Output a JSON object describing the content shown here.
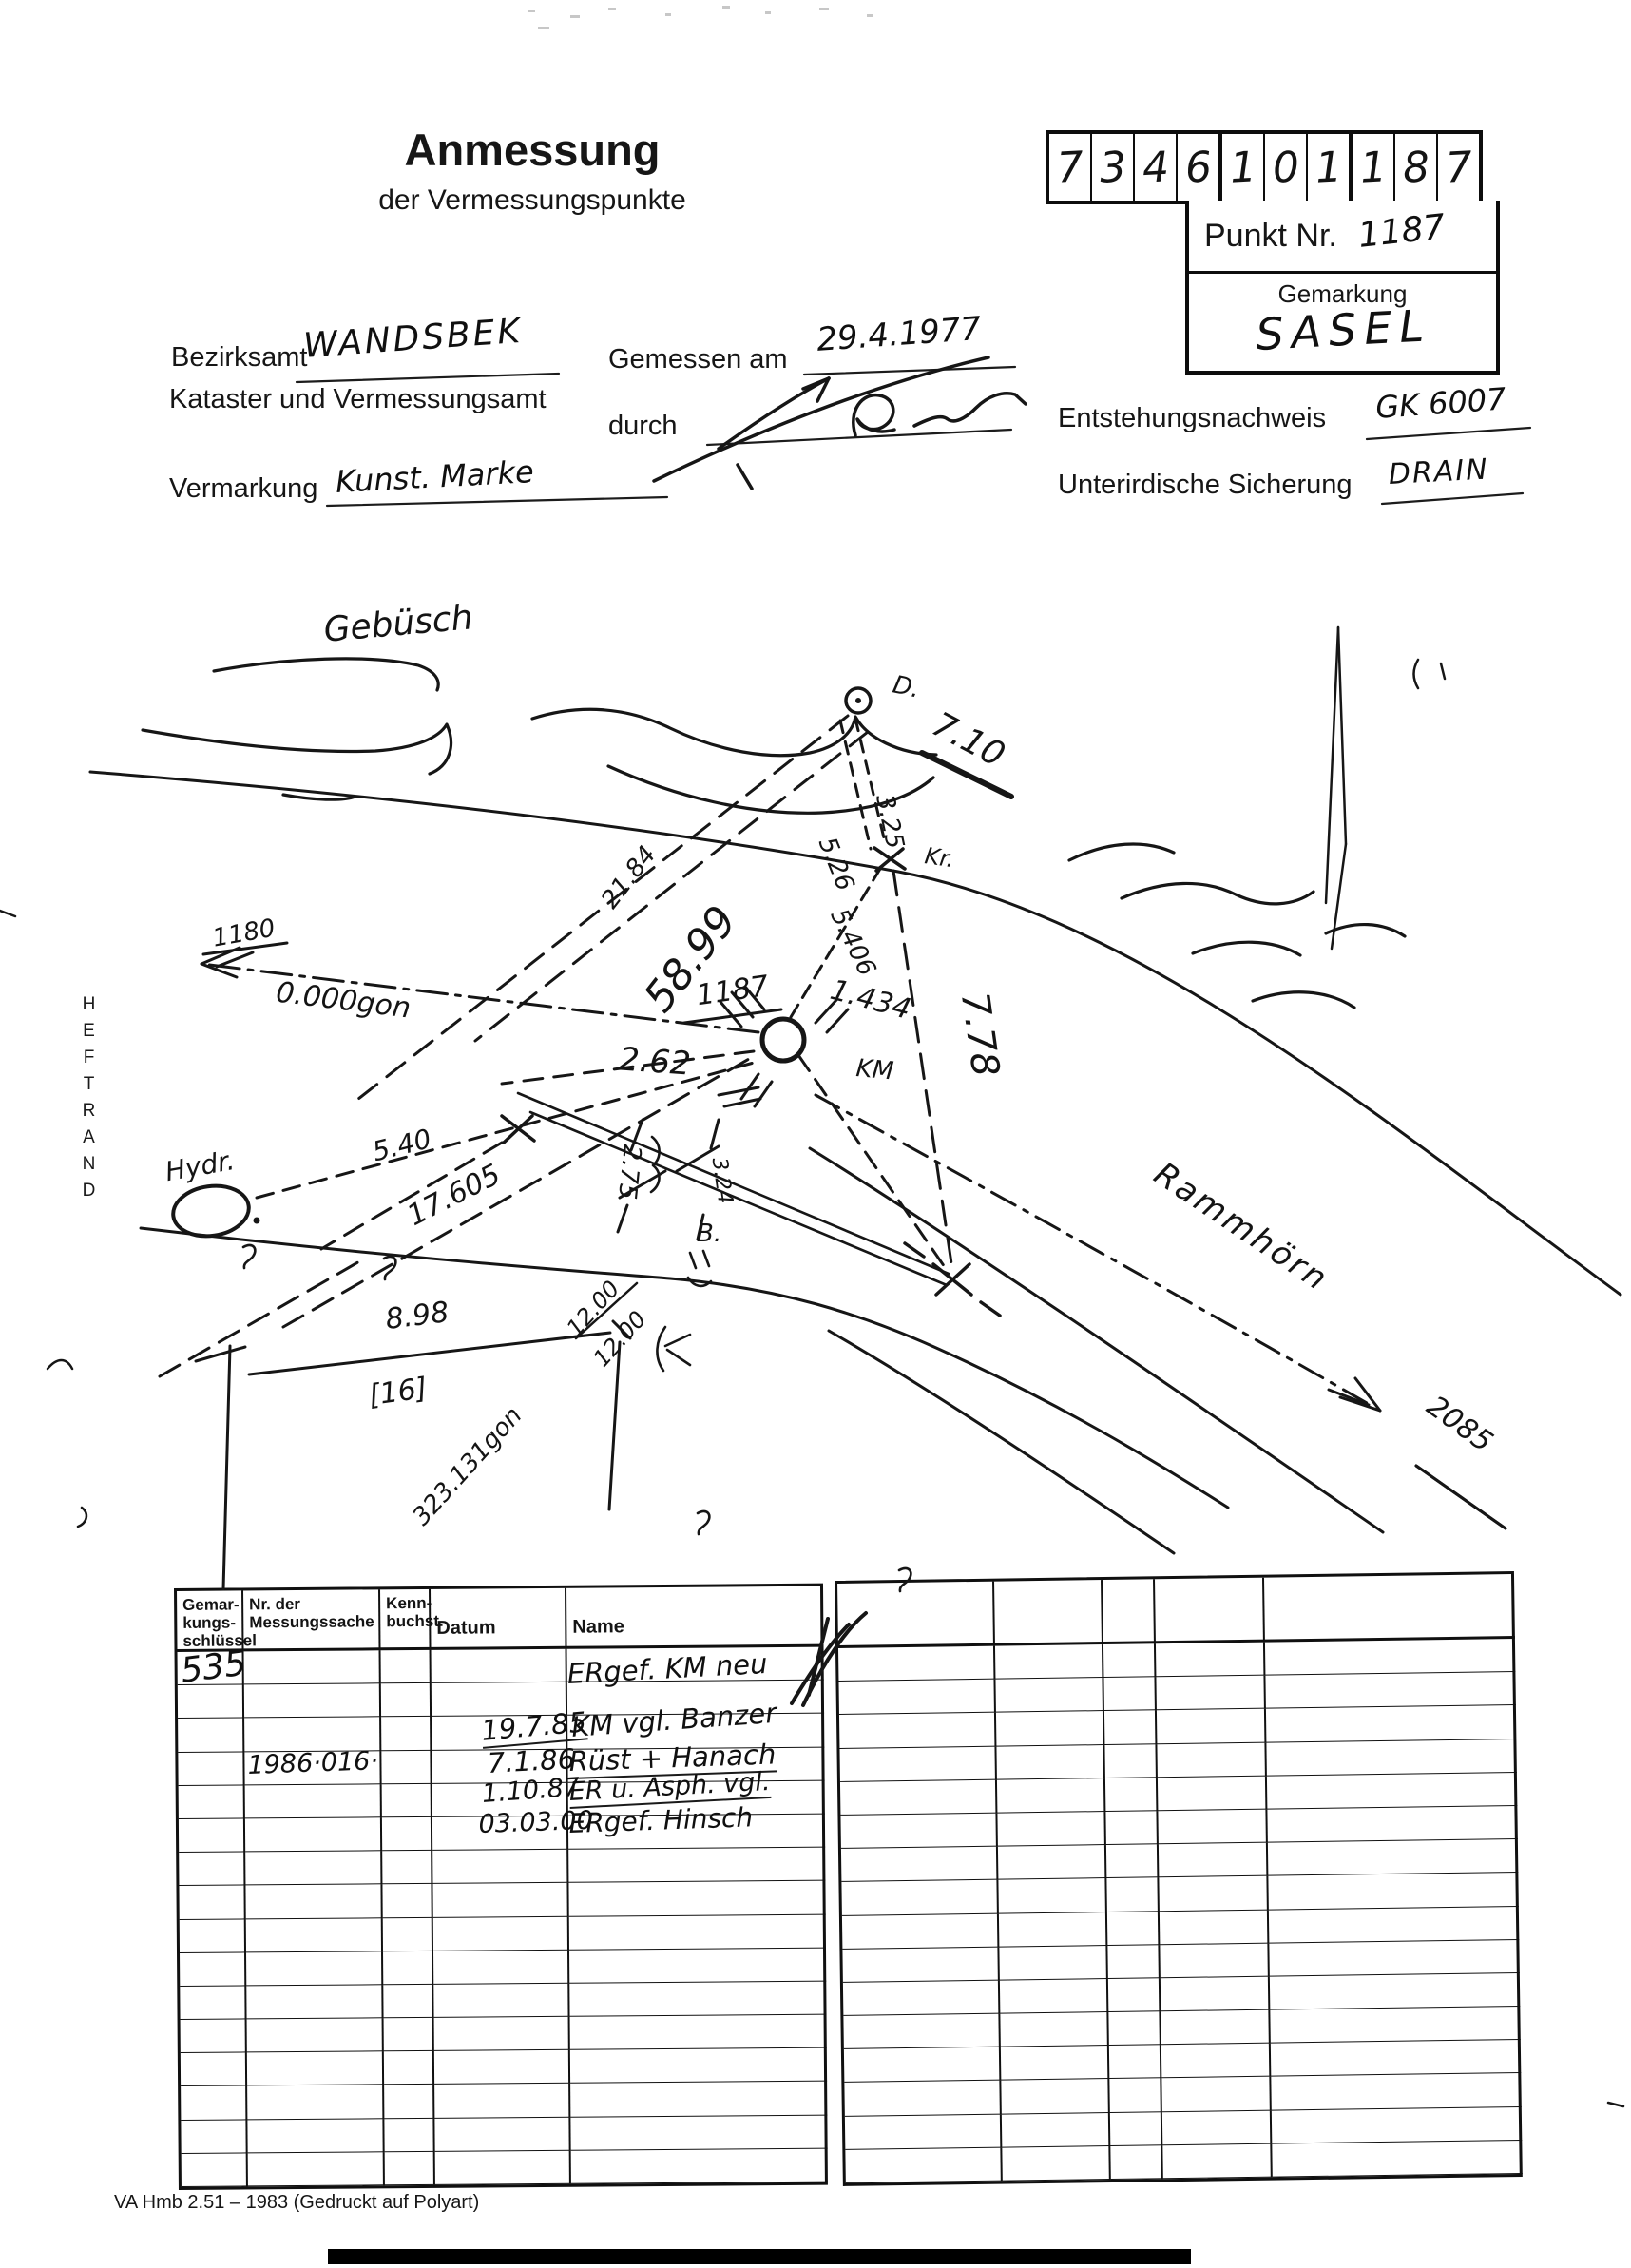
{
  "header": {
    "title": "Anmessung",
    "subtitle": "der Vermessungspunkte",
    "point_code_digits": [
      "7",
      "3",
      "4",
      "6",
      "1",
      "0",
      "1",
      "1",
      "8",
      "7"
    ],
    "punkt_nr_label": "Punkt Nr.",
    "punkt_nr_value": "1187",
    "gemarkung_label": "Gemarkung",
    "gemarkung_value": "SASEL"
  },
  "form": {
    "bezirksamt_label": "Bezirksamt",
    "bezirksamt_value": "WANDSBEK",
    "kataster_line": "Kataster und Vermessungsamt",
    "gemessen_am_label": "Gemessen am",
    "gemessen_am_value": "29.4.1977",
    "durch_label": "durch",
    "vermarkung_label": "Vermarkung",
    "vermarkung_value": "Kunst. Marke",
    "entstehungsnachweis_label": "Entstehungsnachweis",
    "entstehungsnachweis_value": "GK 6007",
    "sicherung_label": "Unterirdische Sicherung",
    "sicherung_value": "DRAIN"
  },
  "margin": {
    "heftrand": "HEFTRAND"
  },
  "sketch": {
    "labels": {
      "area_top": "Gebüsch",
      "point_d": "D.",
      "point_d_height": "7.10",
      "kr": "Kr.",
      "m_21_84": "21.84",
      "m_58_99": "58.99",
      "m_5_26": "5.26",
      "m_3_25": "3.25",
      "m_5_406": "5.406",
      "m_7_78": "7.78",
      "pt_1187": "1187",
      "m_1_434": "1.434",
      "km": "KM",
      "m_2_62": "2.62",
      "pt_1180": "1180",
      "bearing_0": "0.000gon",
      "hydr": "Hydr.",
      "m_5_40": "5.40",
      "m_17_605": "17.605",
      "m_2_75": "2.75",
      "m_3_24": "3.24",
      "b": "B.",
      "m_8_98": "8.98",
      "house_16": "[16]",
      "bearing_323": "323.131gon",
      "m_12_00_a": "12.00",
      "m_12_00_b": "12.00",
      "street": "Rammhörn",
      "pt_2085": "2085"
    }
  },
  "table": {
    "headers": {
      "col0": "Gemar-\nkungs-\nschlüssel",
      "col1": "Nr. der\nMessungssache",
      "col2": "Kenn-\nbuchst.",
      "col3": "Datum",
      "col4": "Name"
    },
    "rows": [
      {
        "schluessel": "535",
        "sache": "",
        "kenn": "",
        "datum": "",
        "name": "ERgef. KM neu"
      },
      {
        "schluessel": "",
        "sache": "",
        "kenn": "",
        "datum": "",
        "name": ""
      },
      {
        "schluessel": "",
        "sache": "",
        "kenn": "",
        "datum": "19.7.85",
        "name": "KM vgl. Banzer"
      },
      {
        "schluessel": "",
        "sache": "1986·016·",
        "kenn": "",
        "datum": "7.1.86",
        "name": "Rüst + Hanach"
      },
      {
        "schluessel": "",
        "sache": "",
        "kenn": "",
        "datum": "1.10.87",
        "name": "ER u. Asph. vgl."
      },
      {
        "schluessel": "",
        "sache": "",
        "kenn": "",
        "datum": "03.03.00",
        "name": "ERgef. Hinsch"
      },
      {
        "schluessel": "",
        "sache": "",
        "kenn": "",
        "datum": "",
        "name": ""
      },
      {
        "schluessel": "",
        "sache": "",
        "kenn": "",
        "datum": "",
        "name": ""
      },
      {
        "schluessel": "",
        "sache": "",
        "kenn": "",
        "datum": "",
        "name": ""
      },
      {
        "schluessel": "",
        "sache": "",
        "kenn": "",
        "datum": "",
        "name": ""
      },
      {
        "schluessel": "",
        "sache": "",
        "kenn": "",
        "datum": "",
        "name": ""
      },
      {
        "schluessel": "",
        "sache": "",
        "kenn": "",
        "datum": "",
        "name": ""
      },
      {
        "schluessel": "",
        "sache": "",
        "kenn": "",
        "datum": "",
        "name": ""
      },
      {
        "schluessel": "",
        "sache": "",
        "kenn": "",
        "datum": "",
        "name": ""
      },
      {
        "schluessel": "",
        "sache": "",
        "kenn": "",
        "datum": "",
        "name": ""
      },
      {
        "schluessel": "",
        "sache": "",
        "kenn": "",
        "datum": "",
        "name": ""
      }
    ],
    "footer": "VA Hmb 2.51 – 1983 (Gedruckt auf Polyart)"
  }
}
